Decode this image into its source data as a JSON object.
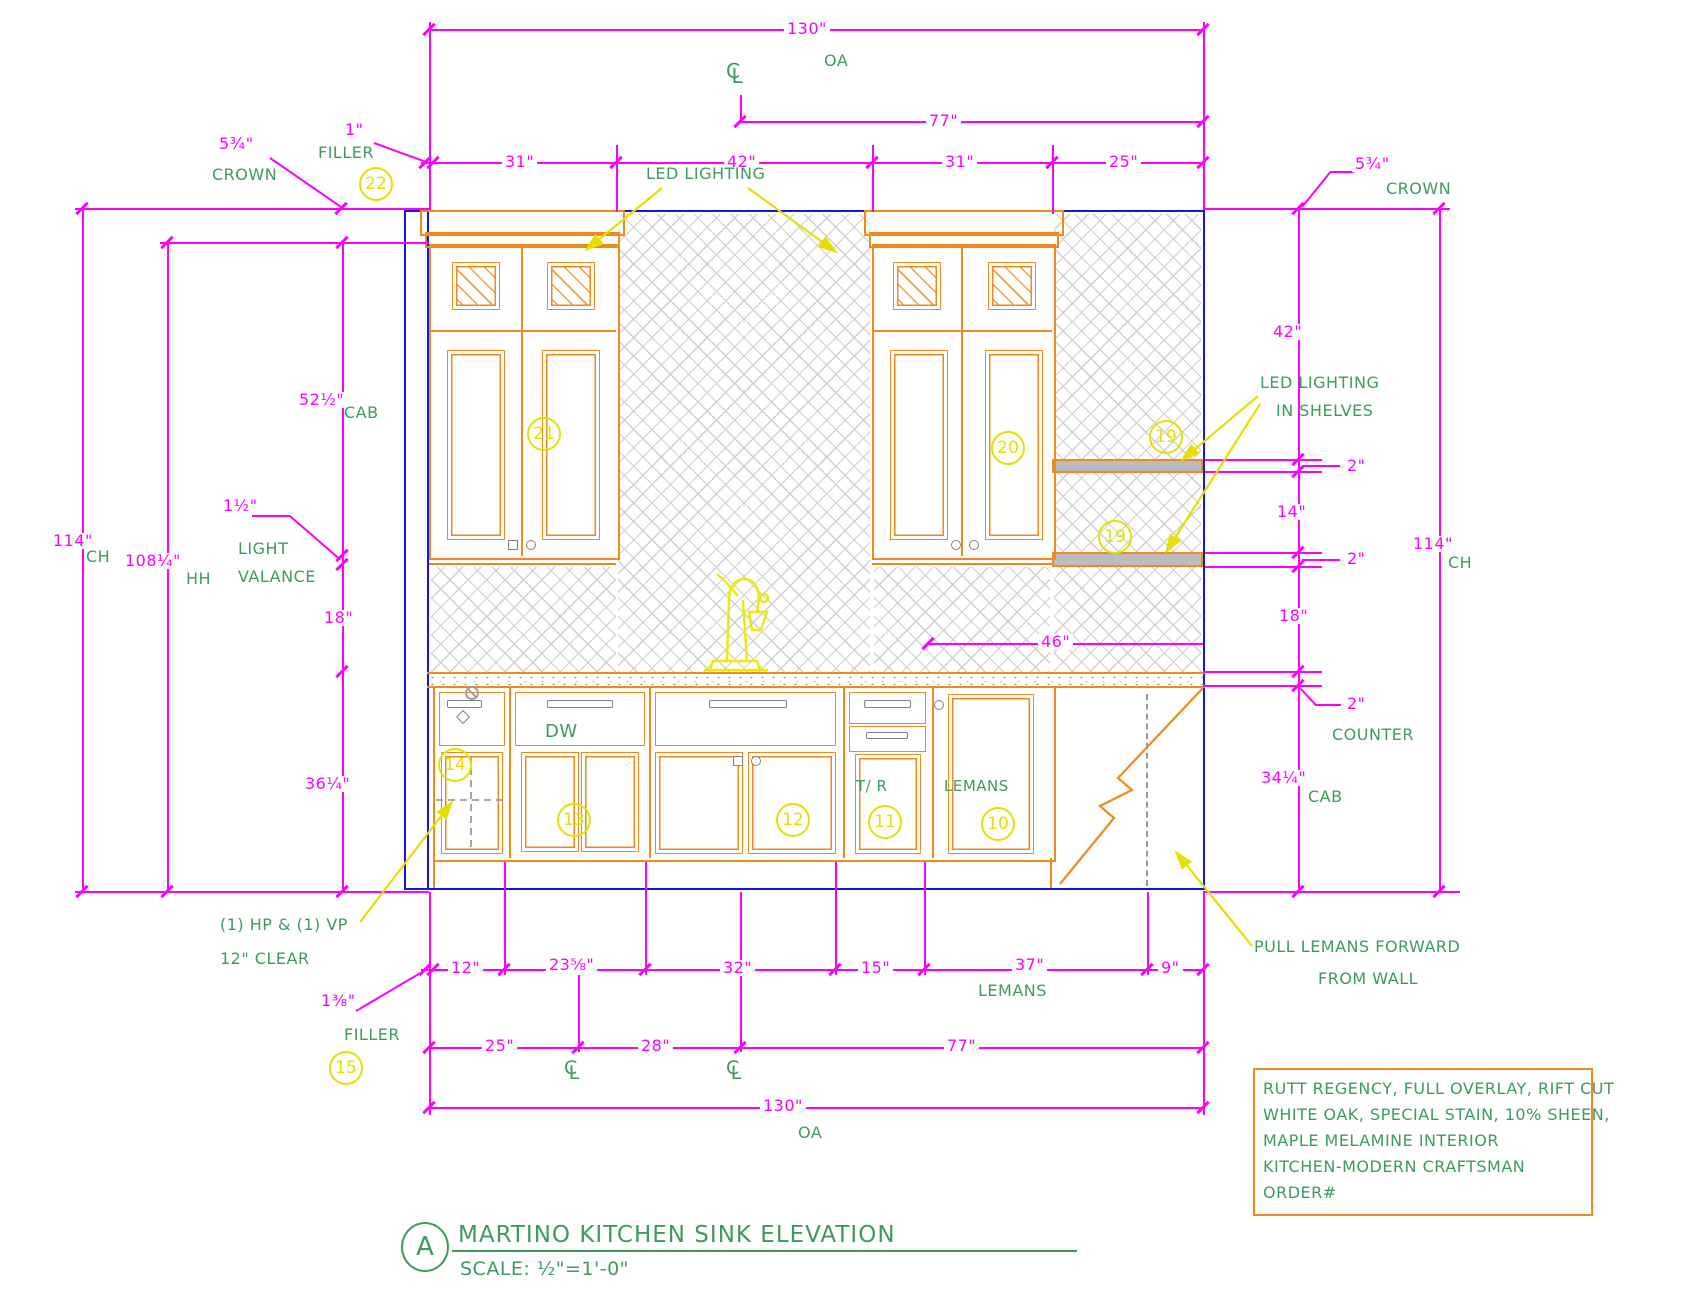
{
  "colors": {
    "dimension": "#ff00ff",
    "annotation": "#3d9b5d",
    "cabinet": "#ef8a1d",
    "callout": "#e6df00",
    "wall": "#1515e8"
  },
  "title_block": {
    "letter": "A",
    "title": "MARTINO KITCHEN SINK ELEVATION",
    "scale": "SCALE: ½\"=1'-0\""
  },
  "note_box": {
    "lines": [
      "RUTT REGENCY, FULL OVERLAY, RIFT CUT",
      "WHITE OAK, SPECIAL STAIN, 10% SHEEN,",
      "MAPLE MELAMINE INTERIOR",
      "KITCHEN-MODERN CRAFTSMAN",
      "ORDER#"
    ]
  },
  "dims": {
    "top_oa": "130\"",
    "top_oa_suffix": "OA",
    "top_77": "77\"",
    "sec_31a": "31\"",
    "sec_42": "42\"",
    "sec_31b": "31\"",
    "sec_25": "25\"",
    "crown_l": "5¾\"",
    "crown_r": "5¾\"",
    "filler_top": "1\"",
    "cab_height": "52½\"",
    "valance": "1½\"",
    "ch_left": "114\"",
    "hh_left": "108¼\"",
    "d18_left": "18\"",
    "base_height": "36¼\"",
    "filler_bottom": "1⅜\"",
    "d42_right": "42\"",
    "shelf_2a": "2\"",
    "d14_right": "14\"",
    "shelf_2b": "2\"",
    "ch_right": "114\"",
    "d18_right": "18\"",
    "counter_2": "2\"",
    "cab_right": "34¼\"",
    "d46": "46\"",
    "d9": "9\"",
    "b12": "12\"",
    "b23": "23⅝\"",
    "b32": "32\"",
    "b15": "15\"",
    "b37": "37\"",
    "b25": "25\"",
    "b28": "28\"",
    "b77": "77\"",
    "b130": "130\"",
    "b_oa": "OA"
  },
  "annotations": {
    "crown": "CROWN",
    "filler": "FILLER",
    "cab": "CAB",
    "ch": "CH",
    "hh": "HH",
    "light": "LIGHT",
    "valance": "VALANCE",
    "counter": "COUNTER",
    "led_lighting": "LED LIGHTING",
    "led_shelves_1": "LED LIGHTING",
    "led_shelves_2": "IN SHELVES",
    "hp_vp": "(1) HP & (1) VP",
    "clear": "12\" CLEAR",
    "pull_1": "PULL LEMANS FORWARD",
    "pull_2": "FROM WALL",
    "lemans_dim": "LEMANS",
    "dw": "DW",
    "tr": "T/ R",
    "lemans": "LEMANS",
    "cl_c": "C",
    "cl_l": "L"
  },
  "callouts": {
    "c22": "22",
    "c21": "21",
    "c20": "20",
    "c19a": "19",
    "c19b": "19",
    "c15": "15",
    "c14": "14",
    "c13": "13",
    "c12": "12",
    "c11": "11",
    "c10": "10"
  }
}
